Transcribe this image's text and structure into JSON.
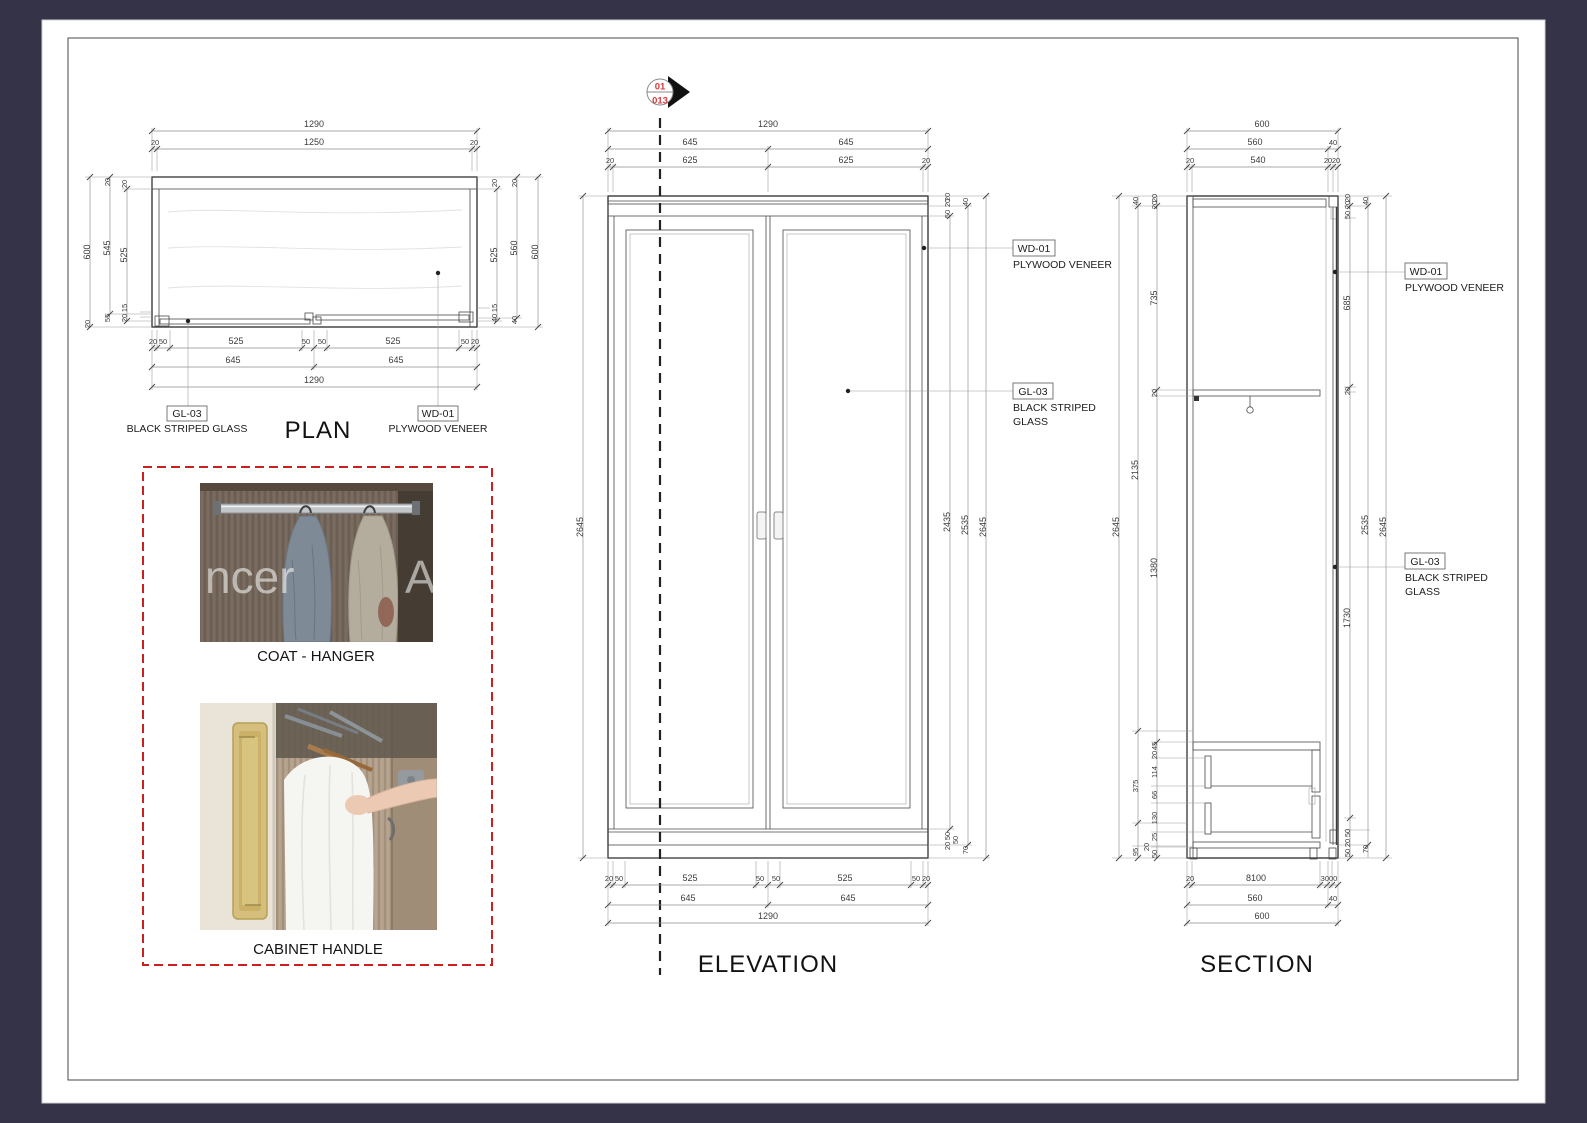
{
  "sheet": {
    "bg": "#343348",
    "page": "#ffffff",
    "frame": "#4a4a4a",
    "red": "#cc1f1f"
  },
  "marker": {
    "top": "01",
    "bottom": "013"
  },
  "materials": {
    "wd_code": "WD-01",
    "wd_name": "PLYWOOD VENEER",
    "gl_code": "GL-03",
    "gl_name": "BLACK STRIPED GLASS",
    "gl_line1": "BLACK STRIPED",
    "gl_line2": "GLASS"
  },
  "views": {
    "plan_title": "PLAN",
    "elevation_title": "ELEVATION",
    "section_title": "SECTION"
  },
  "plan": {
    "top": [
      "1290",
      "20",
      "1250",
      "20"
    ],
    "bottom1": [
      "20",
      "50",
      "525",
      "50",
      "50",
      "525",
      "50",
      "20"
    ],
    "bottom2": [
      "645",
      "645"
    ],
    "bottom3": "1290",
    "left": [
      "600",
      "545",
      "525"
    ],
    "left_top": [
      "20",
      "20"
    ],
    "left_bottom": [
      "15",
      "20",
      "55",
      "20"
    ],
    "right": [
      "525",
      "560",
      "600"
    ],
    "right_top": [
      "20",
      "20"
    ],
    "right_bottom": [
      "15",
      "40",
      "40"
    ]
  },
  "elevation": {
    "top1": "1290",
    "top2": [
      "645",
      "645"
    ],
    "top3": [
      "20",
      "625",
      "625",
      "20"
    ],
    "left": "2645",
    "right": [
      "2435",
      "2535",
      "2645"
    ],
    "right_top": [
      "50",
      "20",
      "20",
      "40"
    ],
    "right_bottom": [
      "50",
      "20",
      "50",
      "70"
    ],
    "bottom1": [
      "20",
      "50",
      "525",
      "50",
      "50",
      "525",
      "50",
      "20"
    ],
    "bottom2": [
      "645",
      "645"
    ],
    "bottom3": "1290"
  },
  "section": {
    "top1": "600",
    "top2": [
      "560",
      "40"
    ],
    "top3": [
      "20",
      "540",
      "20",
      "20"
    ],
    "left_outer": "2645",
    "left_mid": [
      "40",
      "2135",
      "375",
      "95"
    ],
    "left_inner": [
      "20",
      "20",
      "735",
      "20",
      "1380",
      "45",
      "20",
      "114",
      "66",
      "130",
      "25",
      "20",
      "50"
    ],
    "right_inner": [
      "20",
      "20",
      "50",
      "685",
      "20",
      "1730",
      "50",
      "20",
      "50"
    ],
    "right_mid": [
      "40",
      "2535",
      "70"
    ],
    "right_outer": "2645",
    "bottom1": [
      "20",
      "8100",
      "3000"
    ],
    "bottom2": [
      "560",
      "40"
    ],
    "bottom3": "600"
  },
  "references": {
    "coat": "COAT - HANGER",
    "handle": "CABINET HANDLE",
    "watermark1": "ncer",
    "watermark2": "A"
  }
}
